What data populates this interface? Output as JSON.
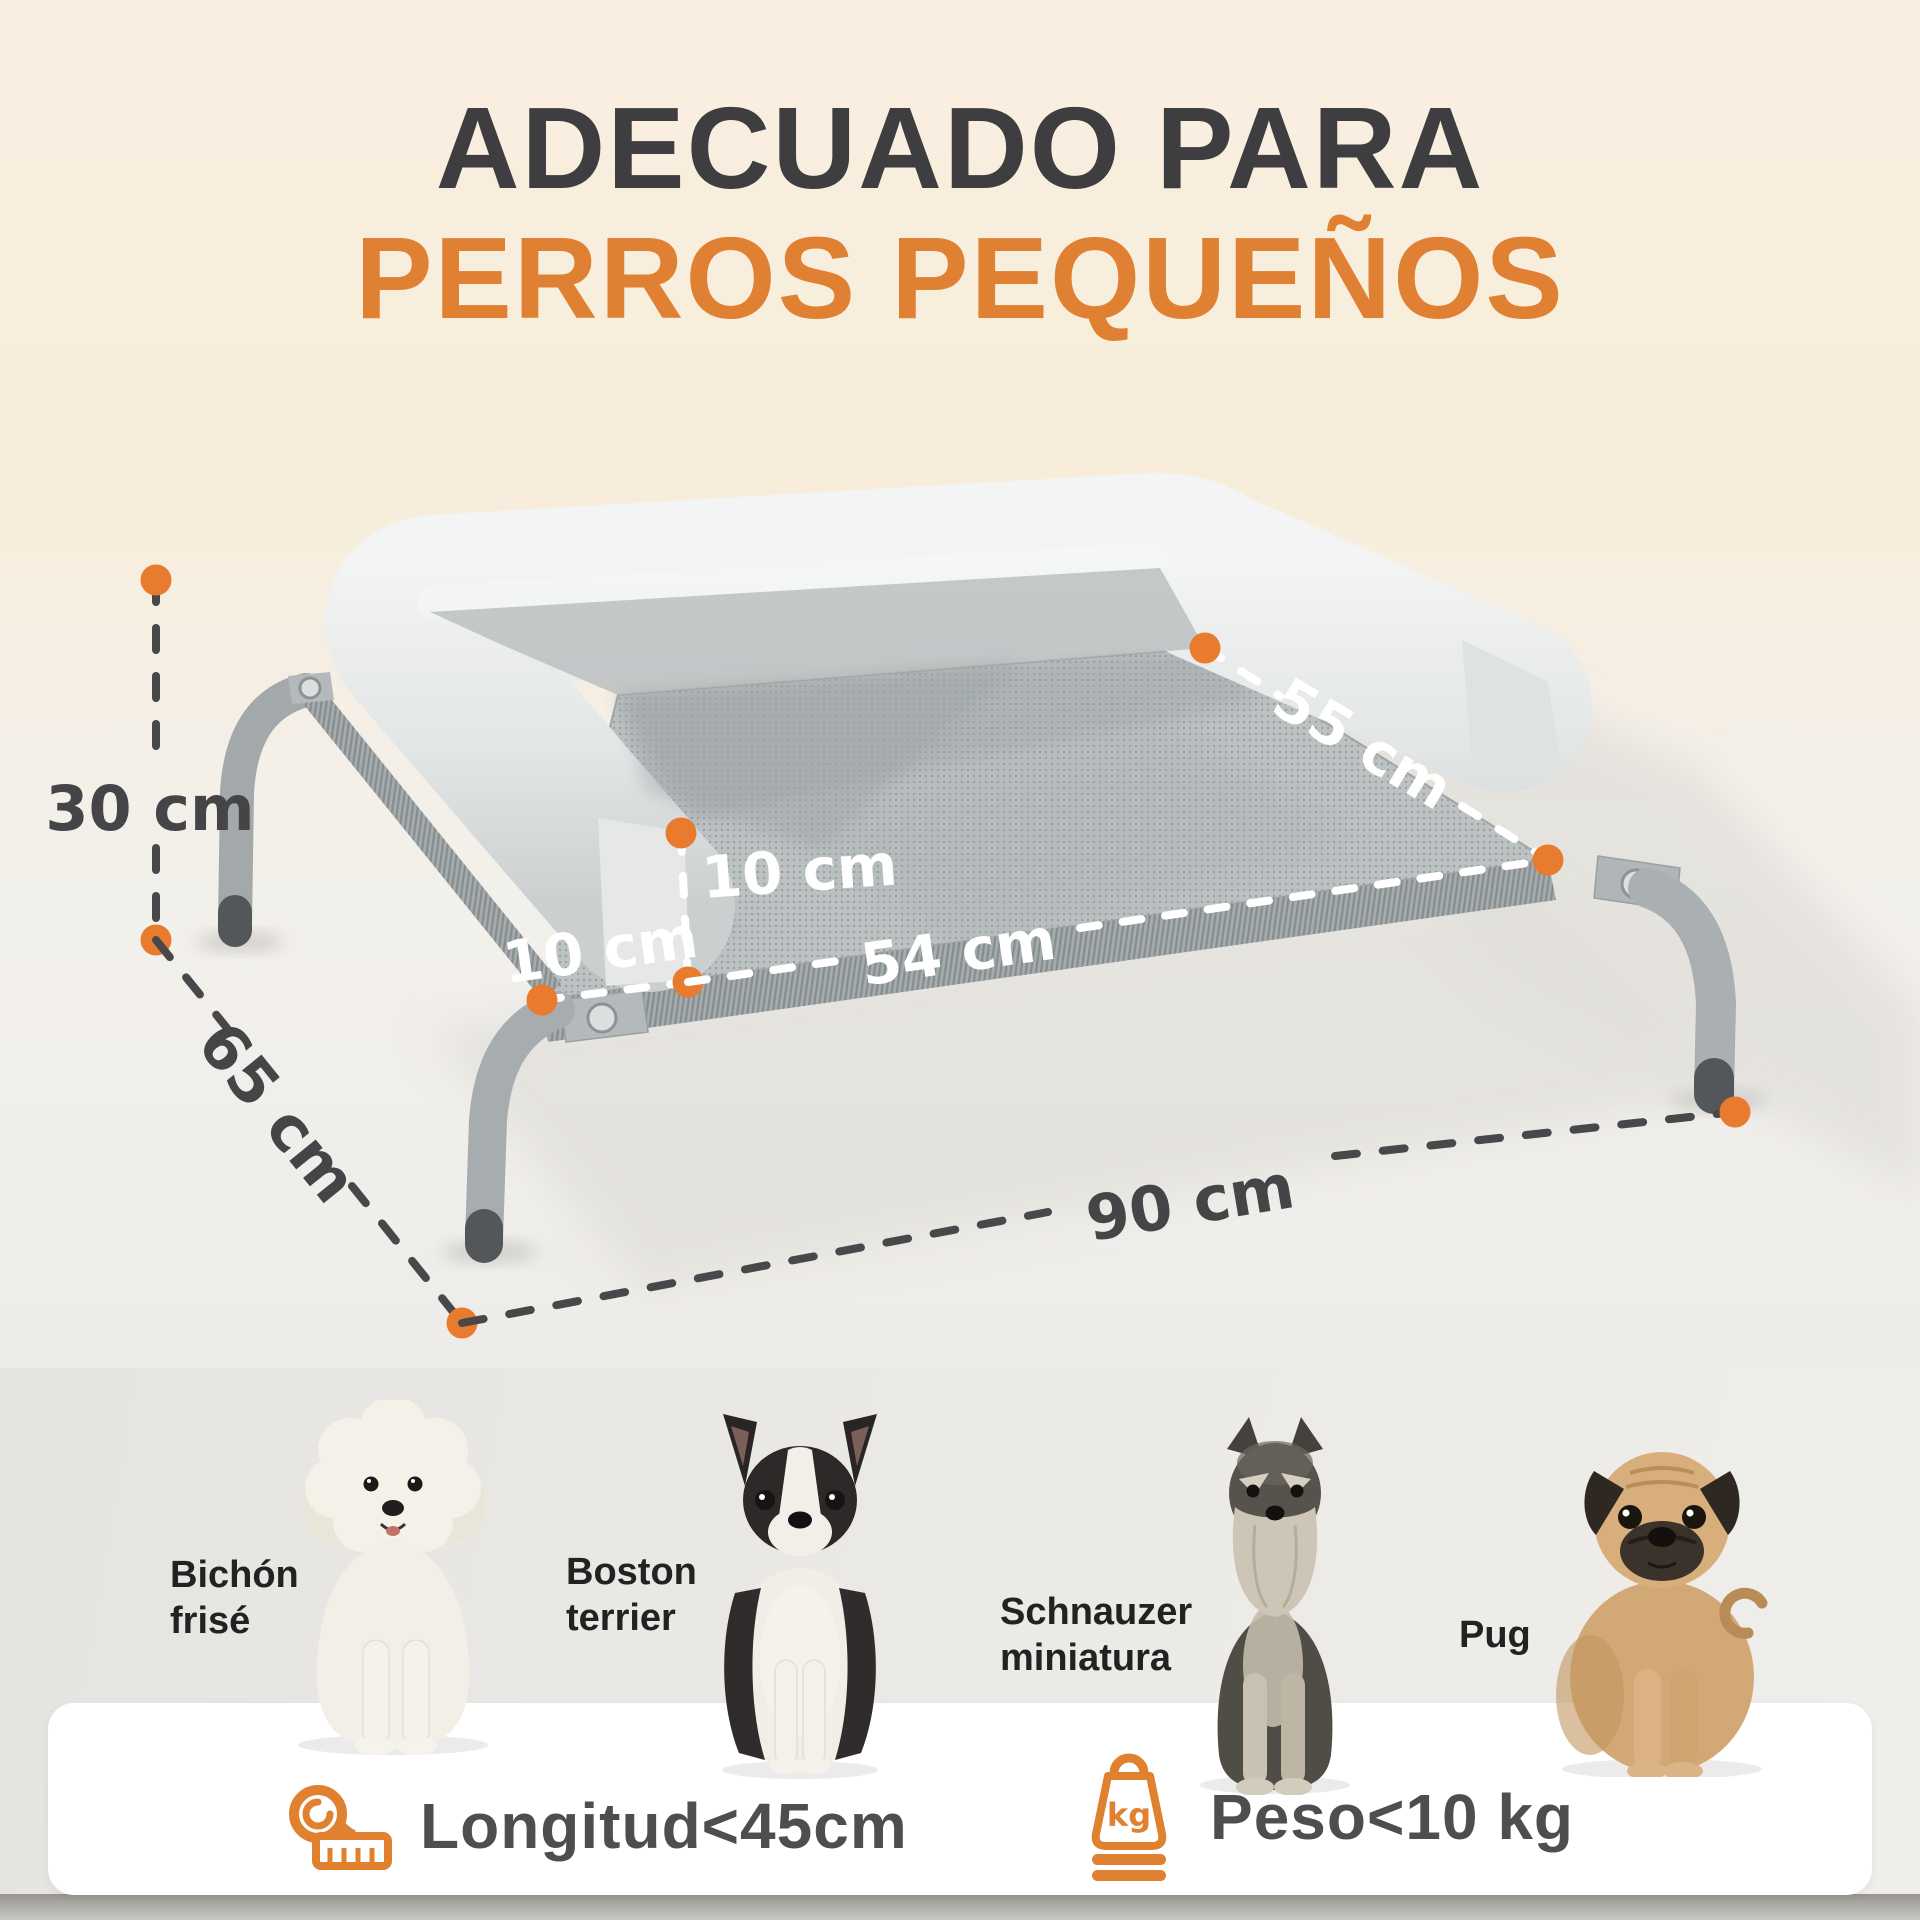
{
  "title": {
    "line1": "ADECUADO PARA",
    "line2": "PERROS PEQUEÑOS"
  },
  "colors": {
    "accent_orange": "#e0812f",
    "title_dark": "#3e3d40",
    "dim_line_dark": "#48484a",
    "dim_line_white": "#ffffff",
    "bg_cream": "#f8eedd",
    "card_white": "#ffffff"
  },
  "dimensions": {
    "height": "30 cm",
    "depth": "65 cm",
    "width": "90 cm",
    "inner_width": "54 cm",
    "inner_depth": "55 cm",
    "bolster_height": "10 cm",
    "bolster_thickness": "10 cm"
  },
  "dogs": [
    {
      "name": "Bichón frisé"
    },
    {
      "name": "Boston terrier"
    },
    {
      "name": "Schnauzer miniatura"
    },
    {
      "name": "Pug"
    }
  ],
  "specs": [
    {
      "icon": "measuring-tape-icon",
      "label": "Longitud<45cm"
    },
    {
      "icon": "weight-kg-icon",
      "icon_text": "kg",
      "label": "Peso<10 kg"
    }
  ]
}
